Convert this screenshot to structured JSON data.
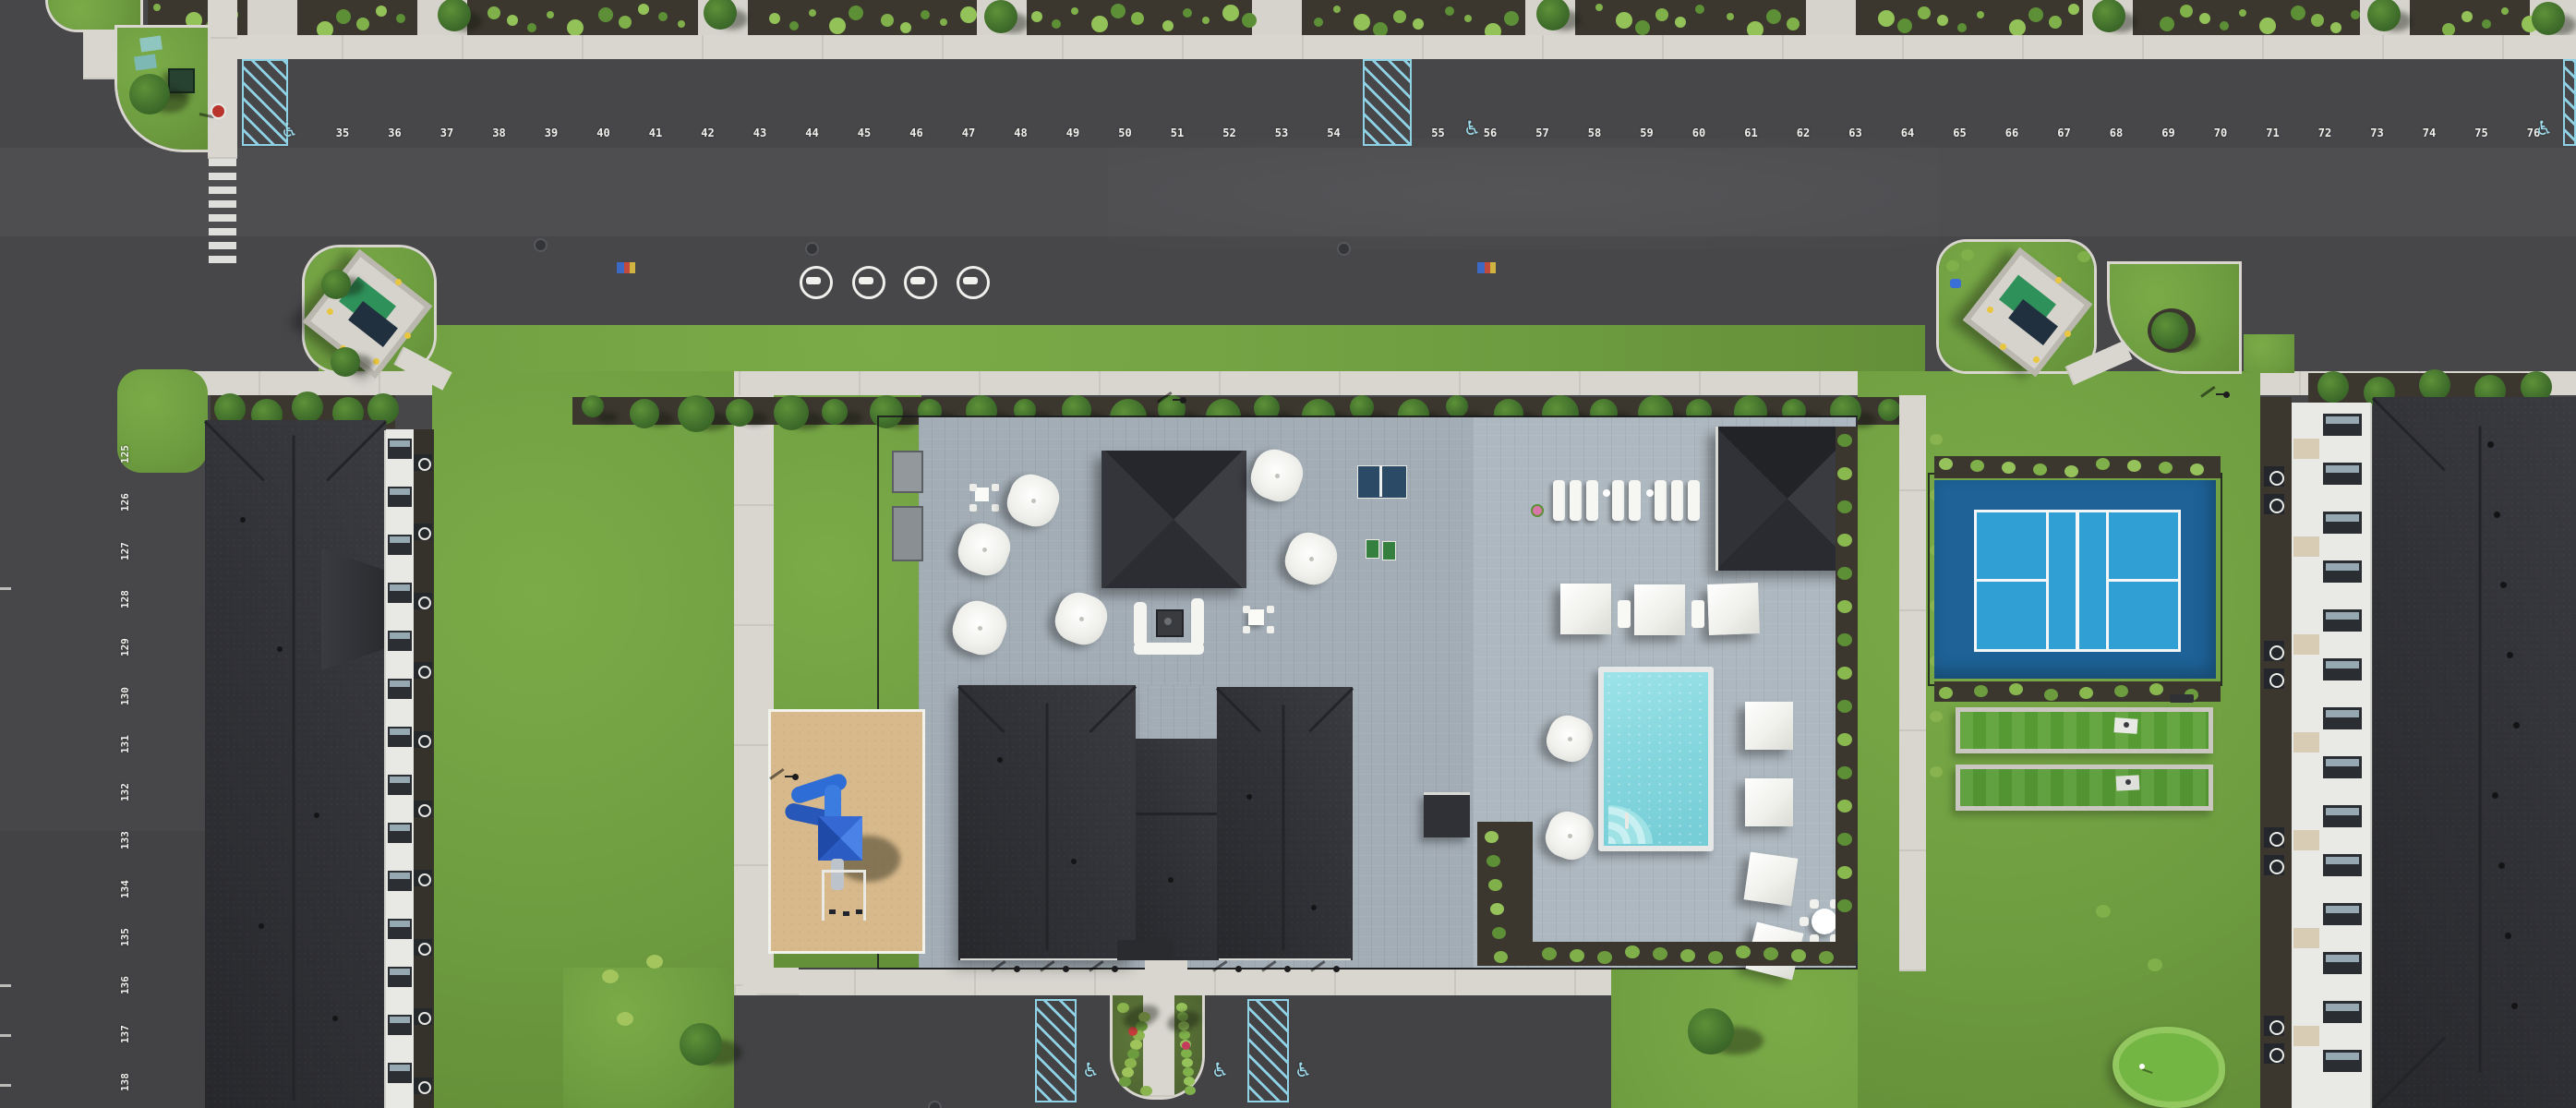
{
  "scene": {
    "type": "aerial-drone-photo",
    "description": "Top-down aerial view of an apartment community: central clubhouse with paver patio and umbrellas, swimming pool with cabanas, pickleball court, game lawns, putting green, playground, trash enclosures, large numbered parking lots and two white apartment buildings with dark shingle roofs",
    "time_of_day": "sunny daytime"
  },
  "parking": {
    "accessible_symbol": "♿",
    "top_row": {
      "numbers": [
        "35",
        "36",
        "37",
        "38",
        "39",
        "40",
        "41",
        "42",
        "43",
        "44",
        "45",
        "46",
        "47",
        "48",
        "49",
        "50",
        "51",
        "52",
        "53",
        "54",
        "55",
        "56",
        "57",
        "58",
        "59",
        "60",
        "61",
        "62",
        "63",
        "64",
        "65",
        "66",
        "67",
        "68",
        "69",
        "70",
        "71",
        "72",
        "73",
        "74",
        "75",
        "76"
      ],
      "hatched_access_aisles": 3
    },
    "left_column": {
      "numbers": [
        "125",
        "126",
        "127",
        "128",
        "129",
        "130",
        "131",
        "132",
        "133",
        "134",
        "135",
        "136",
        "137",
        "138"
      ]
    },
    "bottom_row": {
      "accessible_count": 3,
      "hatched_stalls": 2
    },
    "ev_circle_count": 4,
    "crosswalk_bar_count": 8
  },
  "amenities": {
    "labels": {
      "clubhouse": "clubhouse",
      "pool": "swimming-pool",
      "pool_pavilion": "pool-pavilion",
      "patio_pavilion": "patio-pavilion",
      "pickleball": "pickleball-court",
      "game_lawns": "game-lawns-with-cornhole",
      "putting_green": "putting-green",
      "playground": "playground",
      "ping_pong": "ping-pong-table",
      "fire_pit": "fire-pit-lounge",
      "trash_enclosures": "trash-enclosures"
    },
    "umbrella_count": 8,
    "cabana_count": 7,
    "lounger_count": 8,
    "lamp_count": 9
  },
  "colors": {
    "asphalt": "#47474a",
    "concrete": "#d8d6cf",
    "grass": "#6f9e41",
    "patio_paver": "#a3adb6",
    "pool_deck": "#aeb8c0",
    "pool_water": "#8adbe2",
    "court_outer_blue": "#1e6297",
    "court_inner_blue": "#2f9fd4",
    "turf_green": "#5aa035",
    "putting_green": "#74b643",
    "sand": "#d8b98b",
    "play_structure_blue": "#2e6cd6",
    "roof_dark": "#2e2f34",
    "facade_white": "#e9e9e6",
    "accessible_paint": "#8fd2e6",
    "stall_paint": "#ececе8",
    "dumpster_green": "#2e9159",
    "bollard_yellow": "#e8c63f",
    "flower_red": "#c43b3b"
  }
}
